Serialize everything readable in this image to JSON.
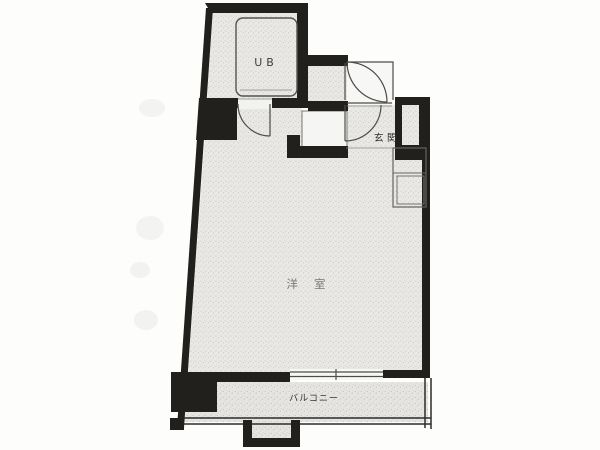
{
  "page": {
    "type": "scanned apartment floor plan",
    "background": "#fdfdfc"
  },
  "labels": {
    "unit_bath": "UB",
    "entrance": "玄関",
    "main_room": "洋室",
    "balcony": "バルコニー"
  },
  "colors": {
    "wall": "#21201d",
    "paper": "#fdfdfc",
    "floor_base": "#eae9e6",
    "floor_dot": "#c8c8c4",
    "line": "#4c4c49"
  }
}
